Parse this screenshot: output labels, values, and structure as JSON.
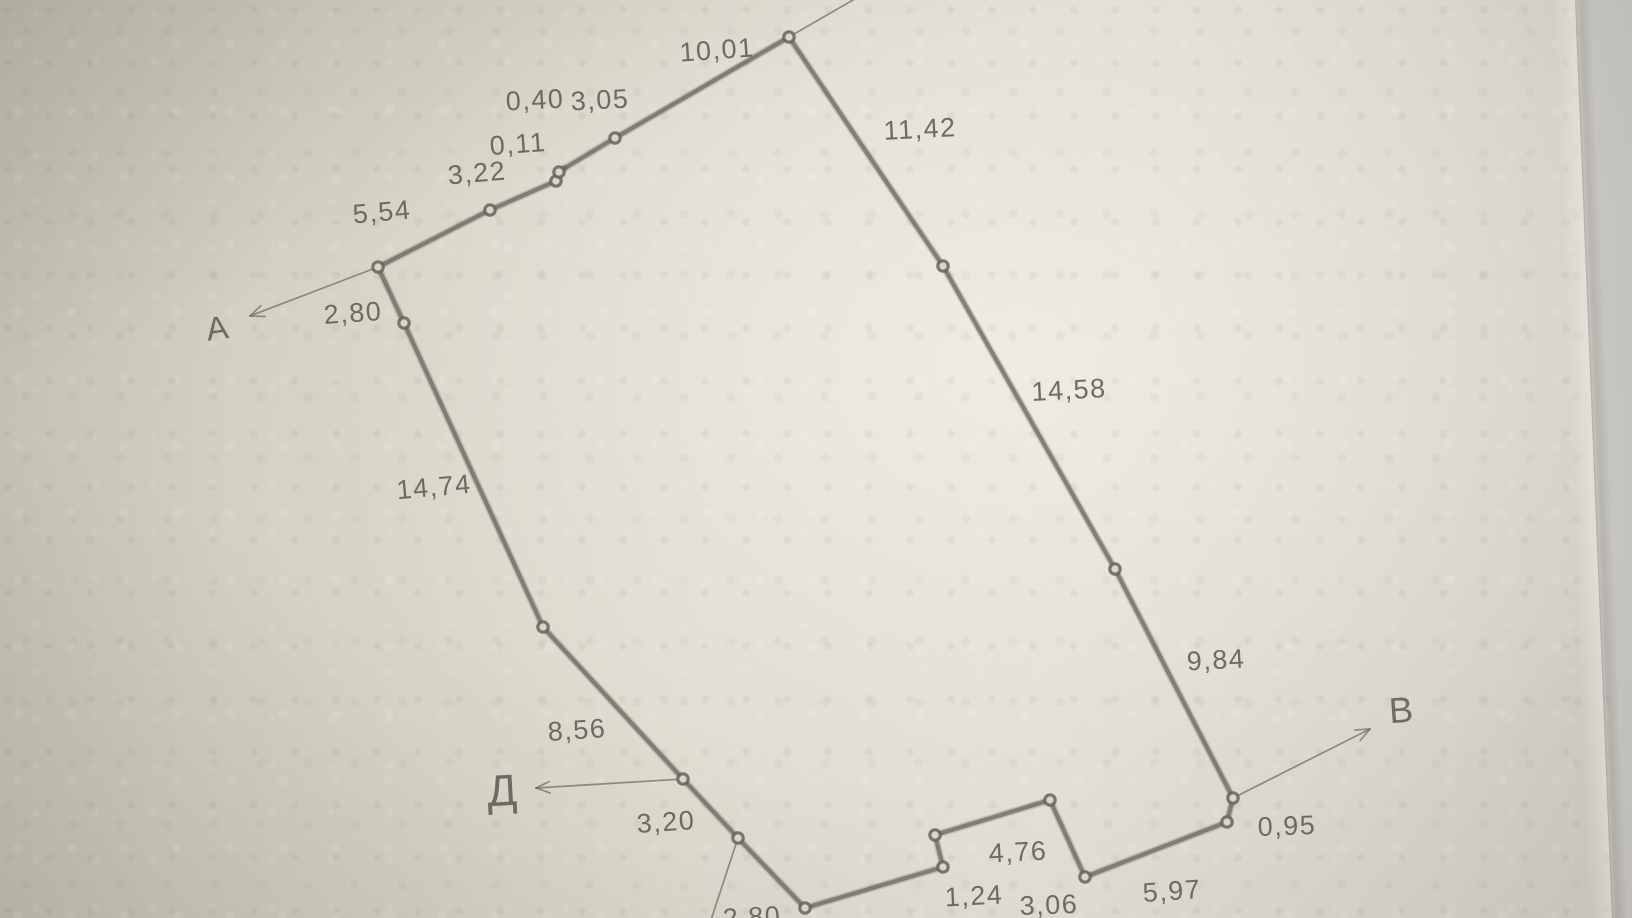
{
  "colors": {
    "ink": "#6a645c",
    "paper": "#dcd9cd",
    "beyond_edge": "#c4c2bd"
  },
  "sketch": {
    "points": [
      {
        "text": "А",
        "x": 217,
        "y": 328,
        "size": 33,
        "rot": -8,
        "arrow": {
          "x1": 378,
          "y1": 267,
          "x2": 250,
          "y2": 316
        }
      },
      {
        "text": "В",
        "x": 1401,
        "y": 710,
        "size": 36,
        "rot": -4,
        "arrow": {
          "x1": 1233,
          "y1": 798,
          "x2": 1370,
          "y2": 729
        }
      },
      {
        "text": "Д",
        "x": 502,
        "y": 791,
        "size": 44,
        "rot": -3,
        "arrow": {
          "x1": 683,
          "y1": 779,
          "x2": 536,
          "y2": 788
        }
      }
    ],
    "vertices": [
      [
        378,
        267
      ],
      [
        490,
        210
      ],
      [
        556,
        181
      ],
      [
        559,
        172
      ],
      [
        615,
        138
      ],
      [
        789,
        37
      ],
      [
        943,
        266
      ],
      [
        1115,
        569
      ],
      [
        1233,
        798
      ],
      [
        1227,
        822
      ],
      [
        1085,
        877
      ],
      [
        1050,
        800
      ],
      [
        935,
        835
      ],
      [
        943,
        867
      ],
      [
        805,
        908
      ],
      [
        738,
        838
      ],
      [
        683,
        779
      ],
      [
        543,
        627
      ],
      [
        404,
        323
      ]
    ],
    "segments": [
      {
        "x1": 378,
        "y1": 267,
        "x2": 490,
        "y2": 210,
        "label": "5,54",
        "lx": 382,
        "ly": 212,
        "rot": -5
      },
      {
        "x1": 490,
        "y1": 210,
        "x2": 556,
        "y2": 181,
        "label": "3,22",
        "lx": 477,
        "ly": 173,
        "rot": -5
      },
      {
        "x1": 556,
        "y1": 181,
        "x2": 559,
        "y2": 172,
        "label": "0,11",
        "lx": 518,
        "ly": 144,
        "rot": -4
      },
      {
        "x1": 559,
        "y1": 172,
        "x2": 565,
        "y2": 168,
        "label": "0,40",
        "lx": 535,
        "ly": 100,
        "rot": -3
      },
      {
        "x1": 565,
        "y1": 168,
        "x2": 615,
        "y2": 138,
        "label": "3,05",
        "lx": 600,
        "ly": 100,
        "rot": -3
      },
      {
        "x1": 615,
        "y1": 138,
        "x2": 789,
        "y2": 37,
        "label": "10,01",
        "lx": 717,
        "ly": 50,
        "rot": -4
      },
      {
        "x1": 789,
        "y1": 37,
        "x2": 943,
        "y2": 266,
        "label": "11,42",
        "lx": 920,
        "ly": 129,
        "rot": -3
      },
      {
        "x1": 943,
        "y1": 266,
        "x2": 1115,
        "y2": 569,
        "label": "14,58",
        "lx": 1069,
        "ly": 390,
        "rot": -3
      },
      {
        "x1": 1115,
        "y1": 569,
        "x2": 1233,
        "y2": 798,
        "label": "9,84",
        "lx": 1216,
        "ly": 660,
        "rot": -3
      },
      {
        "x1": 1233,
        "y1": 798,
        "x2": 1227,
        "y2": 822,
        "label": "0,95",
        "lx": 1287,
        "ly": 826,
        "rot": -2
      },
      {
        "x1": 1227,
        "y1": 822,
        "x2": 1085,
        "y2": 877,
        "label": "5,97",
        "lx": 1172,
        "ly": 891,
        "rot": -4
      },
      {
        "x1": 1085,
        "y1": 877,
        "x2": 1050,
        "y2": 800,
        "label": "3,06",
        "lx": 1049,
        "ly": 905,
        "rot": -2
      },
      {
        "x1": 1050,
        "y1": 800,
        "x2": 935,
        "y2": 835,
        "label": "4,76",
        "lx": 1018,
        "ly": 852,
        "rot": -3
      },
      {
        "x1": 935,
        "y1": 835,
        "x2": 943,
        "y2": 867,
        "label": "1,24",
        "lx": 974,
        "ly": 896,
        "rot": -3
      },
      {
        "x1": 943,
        "y1": 867,
        "x2": 805,
        "y2": 908
      },
      {
        "x1": 805,
        "y1": 908,
        "x2": 738,
        "y2": 838,
        "label": "2,80",
        "lx": 752,
        "ly": 917,
        "rot": -3
      },
      {
        "x1": 738,
        "y1": 838,
        "x2": 683,
        "y2": 779,
        "label": "3,20",
        "lx": 666,
        "ly": 822,
        "rot": -4
      },
      {
        "x1": 683,
        "y1": 779,
        "x2": 543,
        "y2": 627,
        "label": "8,56",
        "lx": 577,
        "ly": 730,
        "rot": -4
      },
      {
        "x1": 543,
        "y1": 627,
        "x2": 404,
        "y2": 323,
        "label": "14,74",
        "lx": 434,
        "ly": 487,
        "rot": -5
      },
      {
        "x1": 404,
        "y1": 323,
        "x2": 378,
        "y2": 267,
        "label": "2,80",
        "lx": 353,
        "ly": 313,
        "rot": -4
      }
    ],
    "extensions": [
      {
        "x1": 789,
        "y1": 37,
        "x2": 910,
        "y2": -33
      },
      {
        "x1": 738,
        "y1": 838,
        "x2": 706,
        "y2": 935
      }
    ]
  }
}
